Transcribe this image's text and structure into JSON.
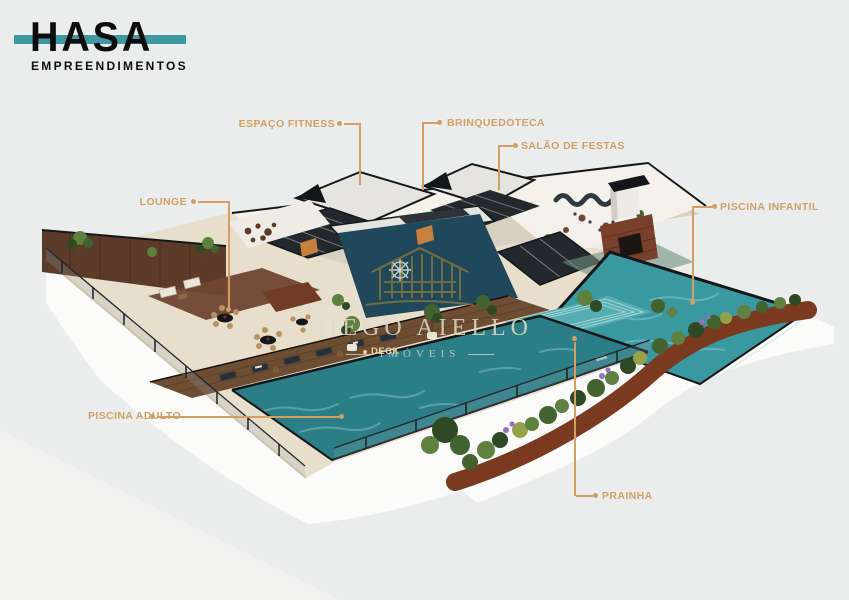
{
  "brand": {
    "name": "HASA",
    "subtitle": "EMPREENDIMENTOS"
  },
  "watermark": {
    "title": "DIEGO AIELLO",
    "subtitle": "IMÓVEIS",
    "icon": "building-outline-icon"
  },
  "callouts": {
    "items": [
      {
        "id": "espaco-fitness",
        "label": "ESPAÇO FITNESS"
      },
      {
        "id": "brinquedoteca",
        "label": "BRINQUEDOTECA"
      },
      {
        "id": "salao-de-festas",
        "label": "SALÃO DE FESTAS"
      },
      {
        "id": "lounge",
        "label": "LOUNGE"
      },
      {
        "id": "piscina-infantil",
        "label": "PISCINA INFANTIL"
      },
      {
        "id": "piscina-adulto",
        "label": "PISCINA ADULTO"
      },
      {
        "id": "prainha",
        "label": "PRAINHA"
      },
      {
        "id": "deck",
        "label": "DECK"
      }
    ]
  },
  "palette": {
    "bg": "#ebedec",
    "base": "#fbfbfa",
    "baselight": "#f1f2f0",
    "deck": "#e8decc",
    "deckline": "#d4c7ae",
    "woodwall": "#5d3b2a",
    "wooddeck": "#6d4e32",
    "rug": "#6e4632",
    "water": "#3a98a0",
    "waterdeep": "#2b7d86",
    "waterlight": "#bfe9e9",
    "stepwater": "#55aeb2",
    "tealwall": "#20475a",
    "whitewall": "#f4f1ea",
    "interior": "#d8d0c1",
    "roof": "#e6e4df",
    "dark": "#141719",
    "glass": "#23282d",
    "glassline": "#cfd5d8",
    "brick": "#79402b",
    "corten": "#7a3a20",
    "green1": "#42632f",
    "green2": "#5f8140",
    "green3": "#2e4a24",
    "green4": "#93a24b",
    "purple": "#8f72ba",
    "orange": "#c8803d",
    "gold": "#d29e63",
    "cream": "#e6d2a2",
    "brandteal": "#3f99a1",
    "ink": "#0d0d0d",
    "wm": "#b9952e",
    "wmtext": "#e2dbc7"
  }
}
